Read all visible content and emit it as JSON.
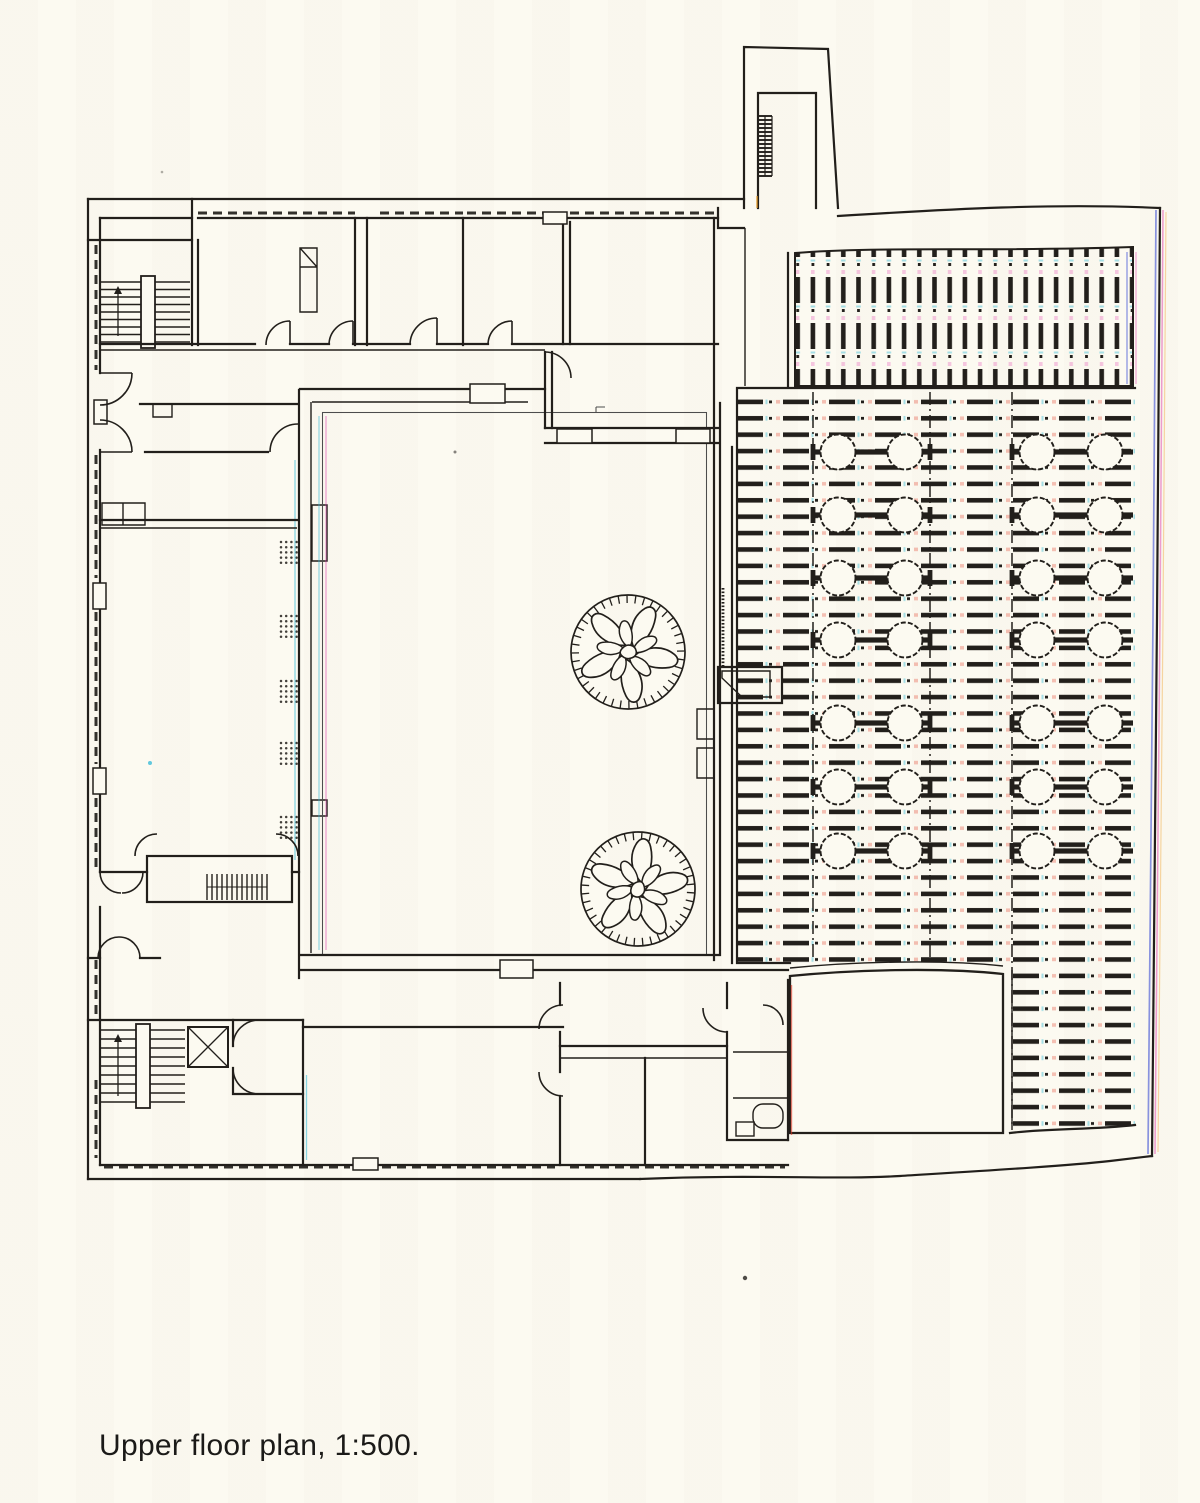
{
  "caption": {
    "text": "Upper floor plan, 1:500."
  },
  "colors": {
    "paper": "#fcfaf1",
    "ink": "#221f1b",
    "cyan": "#3bbcd8",
    "magenta": "#e23fae",
    "blue": "#2a3ed2",
    "red": "#e23726",
    "orange": "#efa02a"
  }
}
